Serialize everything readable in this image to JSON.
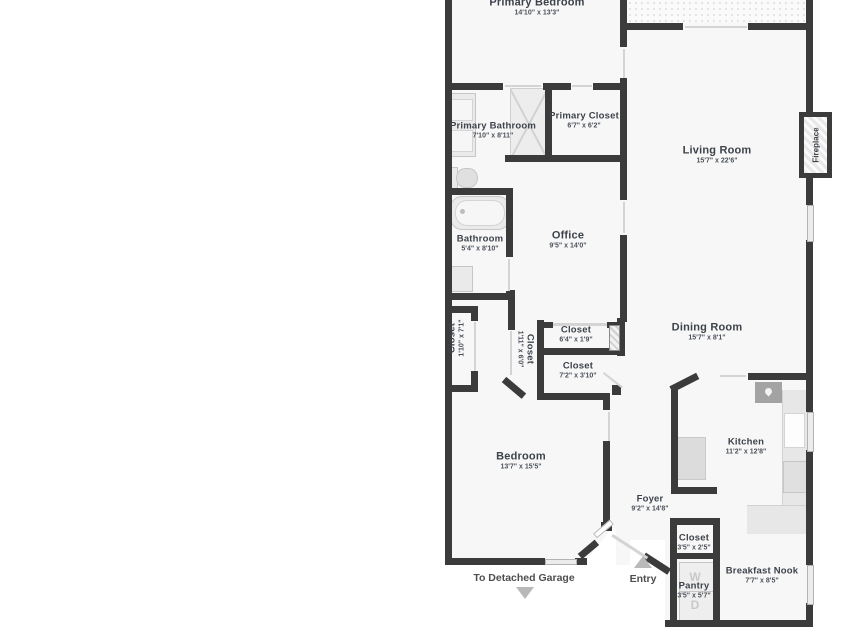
{
  "plan": {
    "rooms": {
      "primary_bedroom": {
        "name": "Primary Bedroom",
        "dims": "14'10\" x 13'3\""
      },
      "primary_bathroom": {
        "name": "Primary Bathroom",
        "dims": "7'10\" x 8'11\""
      },
      "primary_closet": {
        "name": "Primary Closet",
        "dims": "6'7\" x 6'2\""
      },
      "living_room": {
        "name": "Living Room",
        "dims": "15'7\" x 22'6\""
      },
      "office": {
        "name": "Office",
        "dims": "9'5\" x 14'0\""
      },
      "bathroom": {
        "name": "Bathroom",
        "dims": "5'4\" x 8'10\""
      },
      "hall_closet_left": {
        "name": "Closet",
        "dims": "1'10\" x 7'1\""
      },
      "hall_closet_mid": {
        "name": "Closet",
        "dims": "1'11\" x 6'0\""
      },
      "hall_closet_top": {
        "name": "Closet",
        "dims": "6'4\" x 1'9\""
      },
      "hall_closet_bottom": {
        "name": "Closet",
        "dims": "7'2\" x 3'10\""
      },
      "dining_room": {
        "name": "Dining Room",
        "dims": "15'7\" x 8'1\""
      },
      "kitchen": {
        "name": "Kitchen",
        "dims": "11'2\" x 12'8\""
      },
      "bedroom": {
        "name": "Bedroom",
        "dims": "13'7\" x 15'5\""
      },
      "foyer": {
        "name": "Foyer",
        "dims": "9'2\" x 14'8\""
      },
      "foyer_closet": {
        "name": "Closet",
        "dims": "3'5\" x 2'5\""
      },
      "pantry": {
        "name": "Pantry",
        "dims": "3'5\" x 5'7\""
      },
      "breakfast_nook": {
        "name": "Breakfast Nook",
        "dims": "7'7\" x 8'5\""
      }
    },
    "labels": {
      "fireplace": "Fireplace",
      "to_detached_garage": "To Detached Garage",
      "entry": "Entry",
      "washer": "W",
      "dryer": "D"
    },
    "colors": {
      "wall": "#3b3b3b",
      "room_fill": "#f7f7f7",
      "fixture": "#e7e7e7",
      "arrow": "#b9b9b9",
      "text": "#3d434b"
    }
  }
}
